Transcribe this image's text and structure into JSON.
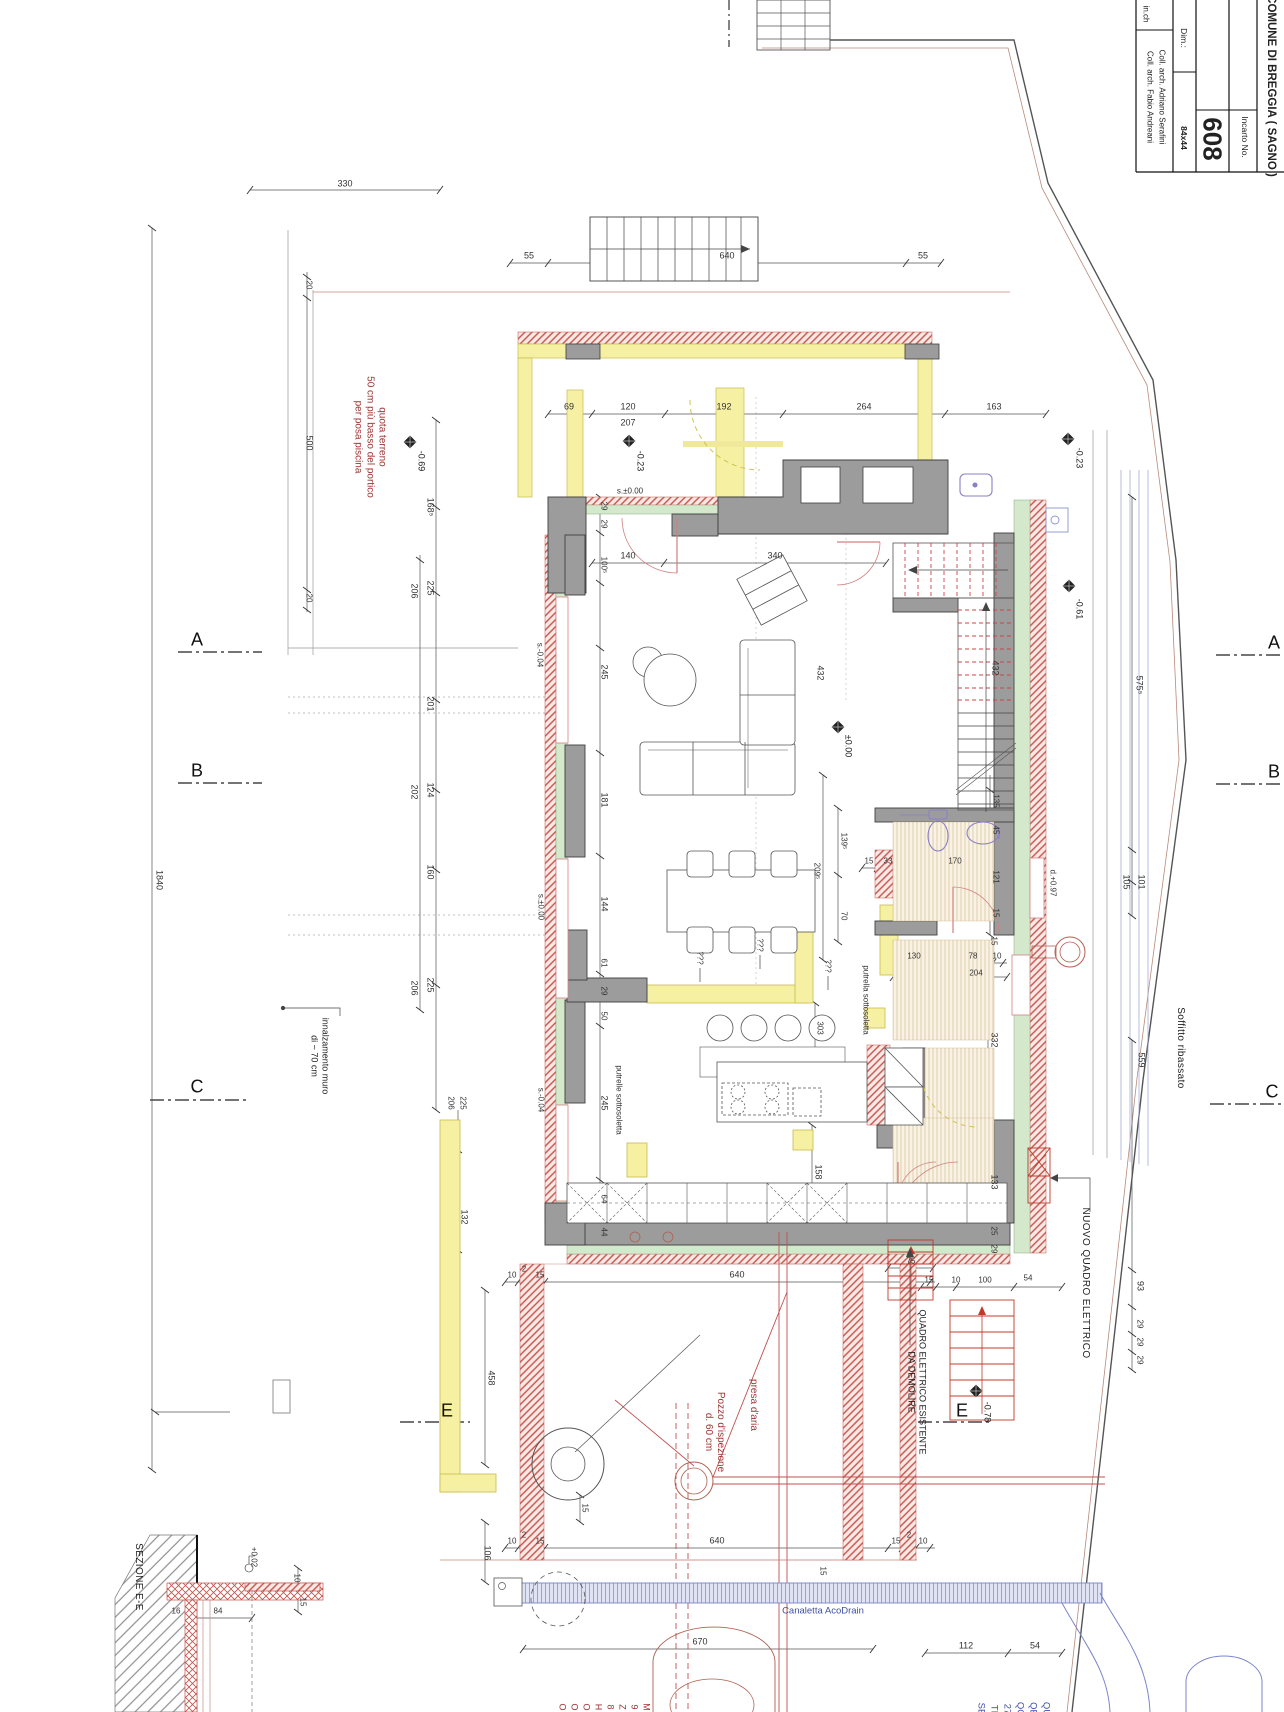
{
  "drawing": {
    "municipality": "COMUNE DI BREGGIA ( SAGNO )",
    "incarto_label": "Incarto No.",
    "incarto_no": "608",
    "dim_label": "Dim.:",
    "dim_value": "84x44",
    "collaborator_1": "Coll. arch. Adriano Serafini",
    "collaborator_2": "Coll. arch. Fabio Andreani",
    "web_fragment": "in.ch"
  },
  "colors": {
    "wall_gray": "#9c9c9c",
    "demolition_yellow": "#f6f0a2",
    "new_construction_red": "#c4524a",
    "insulation_green": "#d4e8cc",
    "plumbing_blue": "#8a93cc",
    "annotation_red": "#a03535"
  },
  "annotations": [
    {
      "t": "330",
      "x": 345,
      "y": 184,
      "cls": "a-dim"
    },
    {
      "t": "20",
      "x": 309,
      "y": 285,
      "cls": "a-dimsm",
      "rot": 1
    },
    {
      "t": "500",
      "x": 309,
      "y": 443,
      "cls": "a-dim",
      "rot": 1
    },
    {
      "t": "20",
      "x": 309,
      "y": 598,
      "cls": "a-dimsm",
      "rot": 1
    },
    {
      "t": "quota terreno\n50 cm più basso del portico\nper posa piscina",
      "x": 370,
      "y": 437,
      "cls": "a-red",
      "rot": 1,
      "n": "note-quota-terreno"
    },
    {
      "t": "-0.69",
      "x": 421,
      "y": 461,
      "cls": "a-lvl",
      "rot": 1,
      "n": "level-minus-069"
    },
    {
      "t": "55",
      "x": 529,
      "y": 256,
      "cls": "a-dim"
    },
    {
      "t": "640",
      "x": 727,
      "y": 256,
      "cls": "a-dim"
    },
    {
      "t": "55",
      "x": 923,
      "y": 256,
      "cls": "a-dim"
    },
    {
      "t": "69",
      "x": 569,
      "y": 407,
      "cls": "a-dim"
    },
    {
      "t": "120",
      "x": 628,
      "y": 407,
      "cls": "a-dim"
    },
    {
      "t": "207",
      "x": 628,
      "y": 423,
      "cls": "a-dim"
    },
    {
      "t": "192",
      "x": 724,
      "y": 407,
      "cls": "a-dim"
    },
    {
      "t": "264",
      "x": 864,
      "y": 407,
      "cls": "a-dim"
    },
    {
      "t": "163",
      "x": 994,
      "y": 407,
      "cls": "a-dim"
    },
    {
      "t": "-0.23",
      "x": 640,
      "y": 461,
      "cls": "a-lvl",
      "rot": 1,
      "n": "level-minus-023"
    },
    {
      "t": "-0.23",
      "x": 1079,
      "y": 458,
      "cls": "a-lvl",
      "rot": 1,
      "n": "level-minus-023"
    },
    {
      "t": "s.±0.00",
      "x": 630,
      "y": 491,
      "cls": "a-dimsm"
    },
    {
      "t": "29",
      "x": 604,
      "y": 506,
      "cls": "a-dimsm",
      "rot": 1
    },
    {
      "t": "29",
      "x": 604,
      "y": 524,
      "cls": "a-dimsm",
      "rot": 1
    },
    {
      "t": "100⁵",
      "x": 604,
      "y": 565,
      "cls": "a-dimsm",
      "rot": 1
    },
    {
      "t": "140",
      "x": 628,
      "y": 556,
      "cls": "a-dim"
    },
    {
      "t": "340",
      "x": 775,
      "y": 556,
      "cls": "a-dim"
    },
    {
      "t": "168⁵",
      "x": 430,
      "y": 507,
      "cls": "a-dim",
      "rot": 1
    },
    {
      "t": "225",
      "x": 430,
      "y": 588,
      "cls": "a-dim",
      "rot": 1
    },
    {
      "t": "206",
      "x": 414,
      "y": 591,
      "cls": "a-dim",
      "rot": 1
    },
    {
      "t": "201",
      "x": 430,
      "y": 704,
      "cls": "a-dim",
      "rot": 1
    },
    {
      "t": "124",
      "x": 430,
      "y": 790,
      "cls": "a-dim",
      "rot": 1
    },
    {
      "t": "202",
      "x": 414,
      "y": 792,
      "cls": "a-dim",
      "rot": 1
    },
    {
      "t": "160",
      "x": 430,
      "y": 872,
      "cls": "a-dim",
      "rot": 1
    },
    {
      "t": "225",
      "x": 430,
      "y": 985,
      "cls": "a-dim",
      "rot": 1
    },
    {
      "t": "206",
      "x": 414,
      "y": 988,
      "cls": "a-dim",
      "rot": 1
    },
    {
      "t": "132",
      "x": 464,
      "y": 1217,
      "cls": "a-dim",
      "rot": 1
    },
    {
      "t": "1840",
      "x": 159,
      "y": 880,
      "cls": "a-dim",
      "rot": 1
    },
    {
      "t": "s.-0.04",
      "x": 540,
      "y": 655,
      "cls": "a-dimsm",
      "rot": 1
    },
    {
      "t": "s.±0.00",
      "x": 541,
      "y": 907,
      "cls": "a-dimsm",
      "rot": 1
    },
    {
      "t": "s.-0.04",
      "x": 541,
      "y": 1100,
      "cls": "a-dimsm",
      "rot": 1
    },
    {
      "t": "245",
      "x": 604,
      "y": 672,
      "cls": "a-dim",
      "rot": 1
    },
    {
      "t": "432",
      "x": 820,
      "y": 673,
      "cls": "a-dim",
      "rot": 1
    },
    {
      "t": "432",
      "x": 995,
      "y": 668,
      "cls": "a-dim",
      "rot": 1
    },
    {
      "t": "575⁵",
      "x": 1139,
      "y": 685,
      "cls": "a-dim",
      "rot": 1
    },
    {
      "t": "-0.61",
      "x": 1079,
      "y": 609,
      "cls": "a-lvl",
      "rot": 1,
      "n": "level-minus-061"
    },
    {
      "t": "±0.00",
      "x": 848,
      "y": 746,
      "cls": "a-lvl",
      "rot": 1,
      "n": "level-zero"
    },
    {
      "t": "181",
      "x": 604,
      "y": 800,
      "cls": "a-dim",
      "rot": 1
    },
    {
      "t": "144",
      "x": 604,
      "y": 904,
      "cls": "a-dim",
      "rot": 1
    },
    {
      "t": "61",
      "x": 604,
      "y": 963,
      "cls": "a-dimsm",
      "rot": 1
    },
    {
      "t": "29",
      "x": 604,
      "y": 991,
      "cls": "a-dimsm",
      "rot": 1
    },
    {
      "t": "50",
      "x": 604,
      "y": 1016,
      "cls": "a-dimsm",
      "rot": 1
    },
    {
      "t": "245",
      "x": 604,
      "y": 1103,
      "cls": "a-dim",
      "rot": 1
    },
    {
      "t": "64",
      "x": 604,
      "y": 1199,
      "cls": "a-dimsm",
      "rot": 1
    },
    {
      "t": "44",
      "x": 604,
      "y": 1232,
      "cls": "a-dimsm",
      "rot": 1
    },
    {
      "t": "139⁵",
      "x": 844,
      "y": 841,
      "cls": "a-dimsm",
      "rot": 1
    },
    {
      "t": "209⁵",
      "x": 817,
      "y": 871,
      "cls": "a-dimsm",
      "rot": 1
    },
    {
      "t": "70",
      "x": 844,
      "y": 916,
      "cls": "a-dimsm",
      "rot": 1
    },
    {
      "t": "15",
      "x": 869,
      "y": 861,
      "cls": "a-dimsm"
    },
    {
      "t": "33",
      "x": 888,
      "y": 861,
      "cls": "a-dimsm"
    },
    {
      "t": "170",
      "x": 955,
      "y": 861,
      "cls": "a-dimsm"
    },
    {
      "t": "135",
      "x": 996,
      "y": 801,
      "cls": "a-dimsm",
      "rot": 1
    },
    {
      "t": "45",
      "x": 996,
      "y": 830,
      "cls": "a-dimsm",
      "rot": 1
    },
    {
      "t": "121",
      "x": 996,
      "y": 877,
      "cls": "a-dimsm",
      "rot": 1
    },
    {
      "t": "15",
      "x": 996,
      "y": 913,
      "cls": "a-dimsm",
      "rot": 1
    },
    {
      "t": "d.+0.97",
      "x": 1053,
      "y": 883,
      "cls": "a-dimsm",
      "rot": 1,
      "n": "label-door-097"
    },
    {
      "t": "105",
      "x": 1126,
      "y": 882,
      "cls": "a-dim",
      "rot": 1
    },
    {
      "t": "101",
      "x": 1141,
      "y": 882,
      "cls": "a-dim",
      "rot": 1
    },
    {
      "t": "putrella sottosoletta",
      "x": 866,
      "y": 1000,
      "cls": "a-dimsm",
      "rot": 1,
      "n": "label-putrella"
    },
    {
      "t": "putrelle sottosoletta",
      "x": 619,
      "y": 1100,
      "cls": "a-dimsm",
      "rot": 1,
      "n": "label-putrelle"
    },
    {
      "t": "???",
      "x": 700,
      "y": 958,
      "cls": "a-dimsm",
      "rot": 1
    },
    {
      "t": "???",
      "x": 760,
      "y": 945,
      "cls": "a-dimsm",
      "rot": 1
    },
    {
      "t": "???",
      "x": 828,
      "y": 966,
      "cls": "a-dimsm",
      "rot": 1
    },
    {
      "t": "130",
      "x": 914,
      "y": 956,
      "cls": "a-dimsm"
    },
    {
      "t": "78",
      "x": 973,
      "y": 956,
      "cls": "a-dimsm"
    },
    {
      "t": "10",
      "x": 997,
      "y": 956,
      "cls": "a-dimsm"
    },
    {
      "t": "204",
      "x": 976,
      "y": 973,
      "cls": "a-dimsm"
    },
    {
      "t": "15",
      "x": 994,
      "y": 941,
      "cls": "a-dimsm",
      "rot": 1
    },
    {
      "t": "303",
      "x": 820,
      "y": 1028,
      "cls": "a-dimsm",
      "rot": 1
    },
    {
      "t": "332",
      "x": 994,
      "y": 1040,
      "cls": "a-dim",
      "rot": 1
    },
    {
      "t": "158",
      "x": 818,
      "y": 1172,
      "cls": "a-dim",
      "rot": 1
    },
    {
      "t": "133",
      "x": 994,
      "y": 1182,
      "cls": "a-dim",
      "rot": 1
    },
    {
      "t": "25",
      "x": 994,
      "y": 1231,
      "cls": "a-dimsm",
      "rot": 1
    },
    {
      "t": "29",
      "x": 994,
      "y": 1249,
      "cls": "a-dimsm",
      "rot": 1
    },
    {
      "t": "75",
      "x": 911,
      "y": 1261,
      "cls": "a-dimsm"
    },
    {
      "t": "15",
      "x": 929,
      "y": 1280,
      "cls": "a-dimsm"
    },
    {
      "t": "10",
      "x": 956,
      "y": 1280,
      "cls": "a-dimsm"
    },
    {
      "t": "100",
      "x": 985,
      "y": 1280,
      "cls": "a-dimsm"
    },
    {
      "t": "54",
      "x": 1028,
      "y": 1278,
      "cls": "a-dimsm"
    },
    {
      "t": "NUOVO QUADRO ELETTRICO",
      "x": 1085,
      "y": 1283,
      "cls": "a-txt",
      "rot": 1,
      "n": "label-nuovo-quadro-elettrico"
    },
    {
      "t": "QUADRO ELETTRICO ESISTENTE\nDA DEMOLIRE",
      "x": 917,
      "y": 1382,
      "cls": "a-txtsm",
      "rot": 1,
      "n": "label-quadro-da-demolire"
    },
    {
      "t": "-0.78",
      "x": 987,
      "y": 1412,
      "cls": "a-lvl",
      "rot": 1,
      "n": "level-minus-078"
    },
    {
      "t": "Soffitto ribassato",
      "x": 1180,
      "y": 1048,
      "cls": "a-txt",
      "rot": 1,
      "n": "label-soffitto-ribassato"
    },
    {
      "t": "559",
      "x": 1141,
      "y": 1060,
      "cls": "a-dim",
      "rot": 1
    },
    {
      "t": "93",
      "x": 1140,
      "y": 1286,
      "cls": "a-dim",
      "rot": 1
    },
    {
      "t": "29",
      "x": 1140,
      "y": 1324,
      "cls": "a-dimsm",
      "rot": 1
    },
    {
      "t": "29",
      "x": 1140,
      "y": 1342,
      "cls": "a-dimsm",
      "rot": 1
    },
    {
      "t": "29",
      "x": 1140,
      "y": 1360,
      "cls": "a-dimsm",
      "rot": 1
    },
    {
      "t": "A",
      "x": 197,
      "y": 640,
      "cls": "a-mk",
      "n": "section-marker-a-left"
    },
    {
      "t": "A",
      "x": 1274,
      "y": 643,
      "cls": "a-mk",
      "n": "section-marker-a-right"
    },
    {
      "t": "B",
      "x": 197,
      "y": 771,
      "cls": "a-mk",
      "n": "section-marker-b-left"
    },
    {
      "t": "B",
      "x": 1274,
      "y": 772,
      "cls": "a-mk",
      "n": "section-marker-b-right"
    },
    {
      "t": "C",
      "x": 197,
      "y": 1087,
      "cls": "a-mk",
      "n": "section-marker-c-left"
    },
    {
      "t": "C",
      "x": 1272,
      "y": 1092,
      "cls": "a-mk",
      "n": "section-marker-c-right"
    },
    {
      "t": "E",
      "x": 447,
      "y": 1411,
      "cls": "a-mk",
      "n": "section-marker-e-left"
    },
    {
      "t": "E",
      "x": 962,
      "y": 1411,
      "cls": "a-mk",
      "n": "section-marker-e-right"
    },
    {
      "t": "innalzamento muro\ndi ~ 70 cm",
      "x": 320,
      "y": 1056,
      "cls": "a-txtsm",
      "rot": 1,
      "n": "label-innalzamento-muro"
    },
    {
      "t": "206",
      "x": 451,
      "y": 1103,
      "cls": "a-dimsm",
      "rot": 1
    },
    {
      "t": "225",
      "x": 463,
      "y": 1103,
      "cls": "a-dimsm",
      "rot": 1
    },
    {
      "t": "458",
      "x": 491,
      "y": 1378,
      "cls": "a-dim",
      "rot": 1
    },
    {
      "t": "106",
      "x": 487,
      "y": 1553,
      "cls": "a-dim",
      "rot": 1
    },
    {
      "t": "10",
      "x": 512,
      "y": 1275,
      "cls": "a-dimsm"
    },
    {
      "t": "2",
      "x": 524,
      "y": 1269,
      "cls": "a-dimsm"
    },
    {
      "t": "15",
      "x": 540,
      "y": 1275,
      "cls": "a-dimsm"
    },
    {
      "t": "640",
      "x": 737,
      "y": 1275,
      "cls": "a-dim"
    },
    {
      "t": "Pozzo d'ispezione\nd. 60 cm",
      "x": 714,
      "y": 1432,
      "cls": "a-red",
      "rot": 1,
      "n": "label-pozzo-ispezione"
    },
    {
      "t": "presa d'aria",
      "x": 753,
      "y": 1405,
      "cls": "a-red",
      "rot": 1,
      "n": "label-presa-aria"
    },
    {
      "t": "10",
      "x": 512,
      "y": 1541,
      "cls": "a-dimsm"
    },
    {
      "t": "2",
      "x": 524,
      "y": 1535,
      "cls": "a-dimsm"
    },
    {
      "t": "15",
      "x": 540,
      "y": 1541,
      "cls": "a-dimsm"
    },
    {
      "t": "640",
      "x": 717,
      "y": 1541,
      "cls": "a-dim"
    },
    {
      "t": "15",
      "x": 896,
      "y": 1541,
      "cls": "a-dimsm"
    },
    {
      "t": "2",
      "x": 909,
      "y": 1535,
      "cls": "a-dimsm"
    },
    {
      "t": "10",
      "x": 923,
      "y": 1541,
      "cls": "a-dimsm"
    },
    {
      "t": "15",
      "x": 585,
      "y": 1508,
      "cls": "a-dimsm",
      "rot": 1
    },
    {
      "t": "15",
      "x": 823,
      "y": 1571,
      "cls": "a-dimsm",
      "rot": 1
    },
    {
      "t": "Canaletta AcoDrain",
      "x": 823,
      "y": 1611,
      "cls": "a-blue",
      "n": "label-canaletta-acodrain"
    },
    {
      "t": "670",
      "x": 700,
      "y": 1642,
      "cls": "a-dim"
    },
    {
      "t": "112",
      "x": 966,
      "y": 1646,
      "cls": "a-dim"
    },
    {
      "t": "54",
      "x": 1035,
      "y": 1646,
      "cls": "a-dim"
    },
    {
      "t": "SEZIONE E-E",
      "x": 138,
      "y": 1577,
      "cls": "a-txt",
      "rot": 1,
      "n": "label-sezione-ee"
    },
    {
      "t": "16",
      "x": 176,
      "y": 1611,
      "cls": "a-dimsm"
    },
    {
      "t": "84",
      "x": 218,
      "y": 1611,
      "cls": "a-dimsm"
    },
    {
      "t": "10",
      "x": 297,
      "y": 1578,
      "cls": "a-dimsm",
      "rot": 1
    },
    {
      "t": "15",
      "x": 303,
      "y": 1602,
      "cls": "a-dimsm",
      "rot": 1
    },
    {
      "t": "+0.02",
      "x": 254,
      "y": 1557,
      "cls": "a-dimsm",
      "rot": 1,
      "n": "level-plus-002"
    },
    {
      "t": "O",
      "x": 562,
      "y": 1707,
      "cls": "a-redsm",
      "rot": 1
    },
    {
      "t": "O",
      "x": 574,
      "y": 1707,
      "cls": "a-redsm",
      "rot": 1
    },
    {
      "t": "O",
      "x": 586,
      "y": 1707,
      "cls": "a-redsm",
      "rot": 1
    },
    {
      "t": "H",
      "x": 598,
      "y": 1707,
      "cls": "a-redsm",
      "rot": 1
    },
    {
      "t": "8",
      "x": 610,
      "y": 1707,
      "cls": "a-redsm",
      "rot": 1
    },
    {
      "t": "Z",
      "x": 622,
      "y": 1707,
      "cls": "a-redsm",
      "rot": 1
    },
    {
      "t": "9",
      "x": 634,
      "y": 1707,
      "cls": "a-redsm",
      "rot": 1
    },
    {
      "t": "M",
      "x": 646,
      "y": 1707,
      "cls": "a-redsm",
      "rot": 1
    },
    {
      "t": "SE",
      "x": 981,
      "y": 1709,
      "cls": "a-blue",
      "rot": 1
    },
    {
      "t": "TI",
      "x": 994,
      "y": 1709,
      "cls": "a-blue",
      "rot": 1
    },
    {
      "t": "27",
      "x": 1007,
      "y": 1709,
      "cls": "a-blue",
      "rot": 1
    },
    {
      "t": "QC",
      "x": 1020,
      "y": 1709,
      "cls": "a-blue",
      "rot": 1
    },
    {
      "t": "QE",
      "x": 1033,
      "y": 1709,
      "cls": "a-blue",
      "rot": 1
    },
    {
      "t": "QU",
      "x": 1046,
      "y": 1709,
      "cls": "a-blue",
      "rot": 1
    }
  ]
}
